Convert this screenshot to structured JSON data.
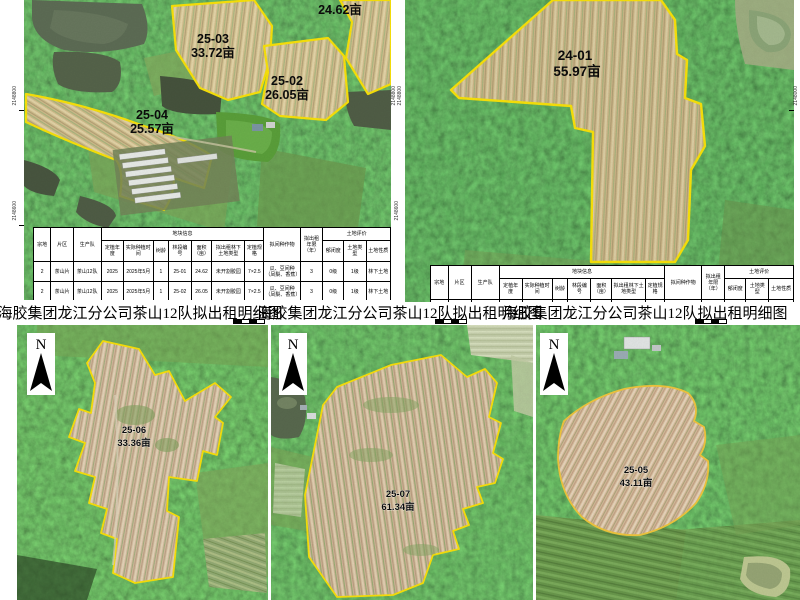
{
  "band": {
    "title": "海胶集团龙江分公司茶山12队拟出租明细图"
  },
  "coords": {
    "tl_left": [
      "2148800",
      "2148600"
    ],
    "gutter": [
      "2148800",
      "2148800",
      "2148600"
    ],
    "tr_right": [
      "2148000"
    ]
  },
  "top_left_map": {
    "parcels": {
      "p2501": {
        "area": "24.62亩"
      },
      "p2503": {
        "id": "25-03",
        "area": "33.72亩"
      },
      "p2502": {
        "id": "25-02",
        "area": "26.05亩"
      },
      "p2504": {
        "id": "25-04",
        "area": "25.57亩"
      }
    }
  },
  "top_right_map": {
    "parcel": {
      "id": "24-01",
      "area": "55.97亩"
    }
  },
  "bottom_maps": {
    "b1": {
      "north": "N",
      "parcel": {
        "id": "25-06",
        "area": "33.36亩"
      }
    },
    "b2": {
      "north": "N",
      "parcel": {
        "id": "25-07",
        "area": "61.34亩"
      }
    },
    "b3": {
      "north": "N",
      "parcel": {
        "id": "25-05",
        "area": "43.11亩"
      }
    }
  },
  "table": {
    "group_headers": {
      "zongdi": "宗地",
      "pianqu": "片区",
      "shengchandui": "生产队",
      "dikuai": "地块信息",
      "jianzhong": "拟间种作物",
      "nianxian": "拟出租年限（年）",
      "pingjia": "土地评价"
    },
    "dikuai_sub": [
      "定植年度",
      "实际种植时间",
      "树龄",
      "林段编号",
      "面积（亩）",
      "拟出租林下土地类型",
      "定植规格"
    ],
    "pingjia_sub": [
      "郁闭度",
      "土地类型",
      "土地性质"
    ],
    "rows": [
      [
        "2",
        "茶山片",
        "茶山12队",
        "2025",
        "2025年5月",
        "1",
        "25-01",
        "24.62",
        "未开割胶园",
        "7×2.5",
        "瓜、豆间种（凤梨、香蕉）",
        "3",
        "0级",
        "1级",
        "林下土地"
      ],
      [
        "2",
        "茶山片",
        "茶山12队",
        "2025",
        "2025年5月",
        "1",
        "25-02",
        "26.05",
        "未开割胶园",
        "7×2.5",
        "瓜、豆间种（凤梨、香蕉）",
        "3",
        "0级",
        "1级",
        "林下土地"
      ]
    ]
  }
}
